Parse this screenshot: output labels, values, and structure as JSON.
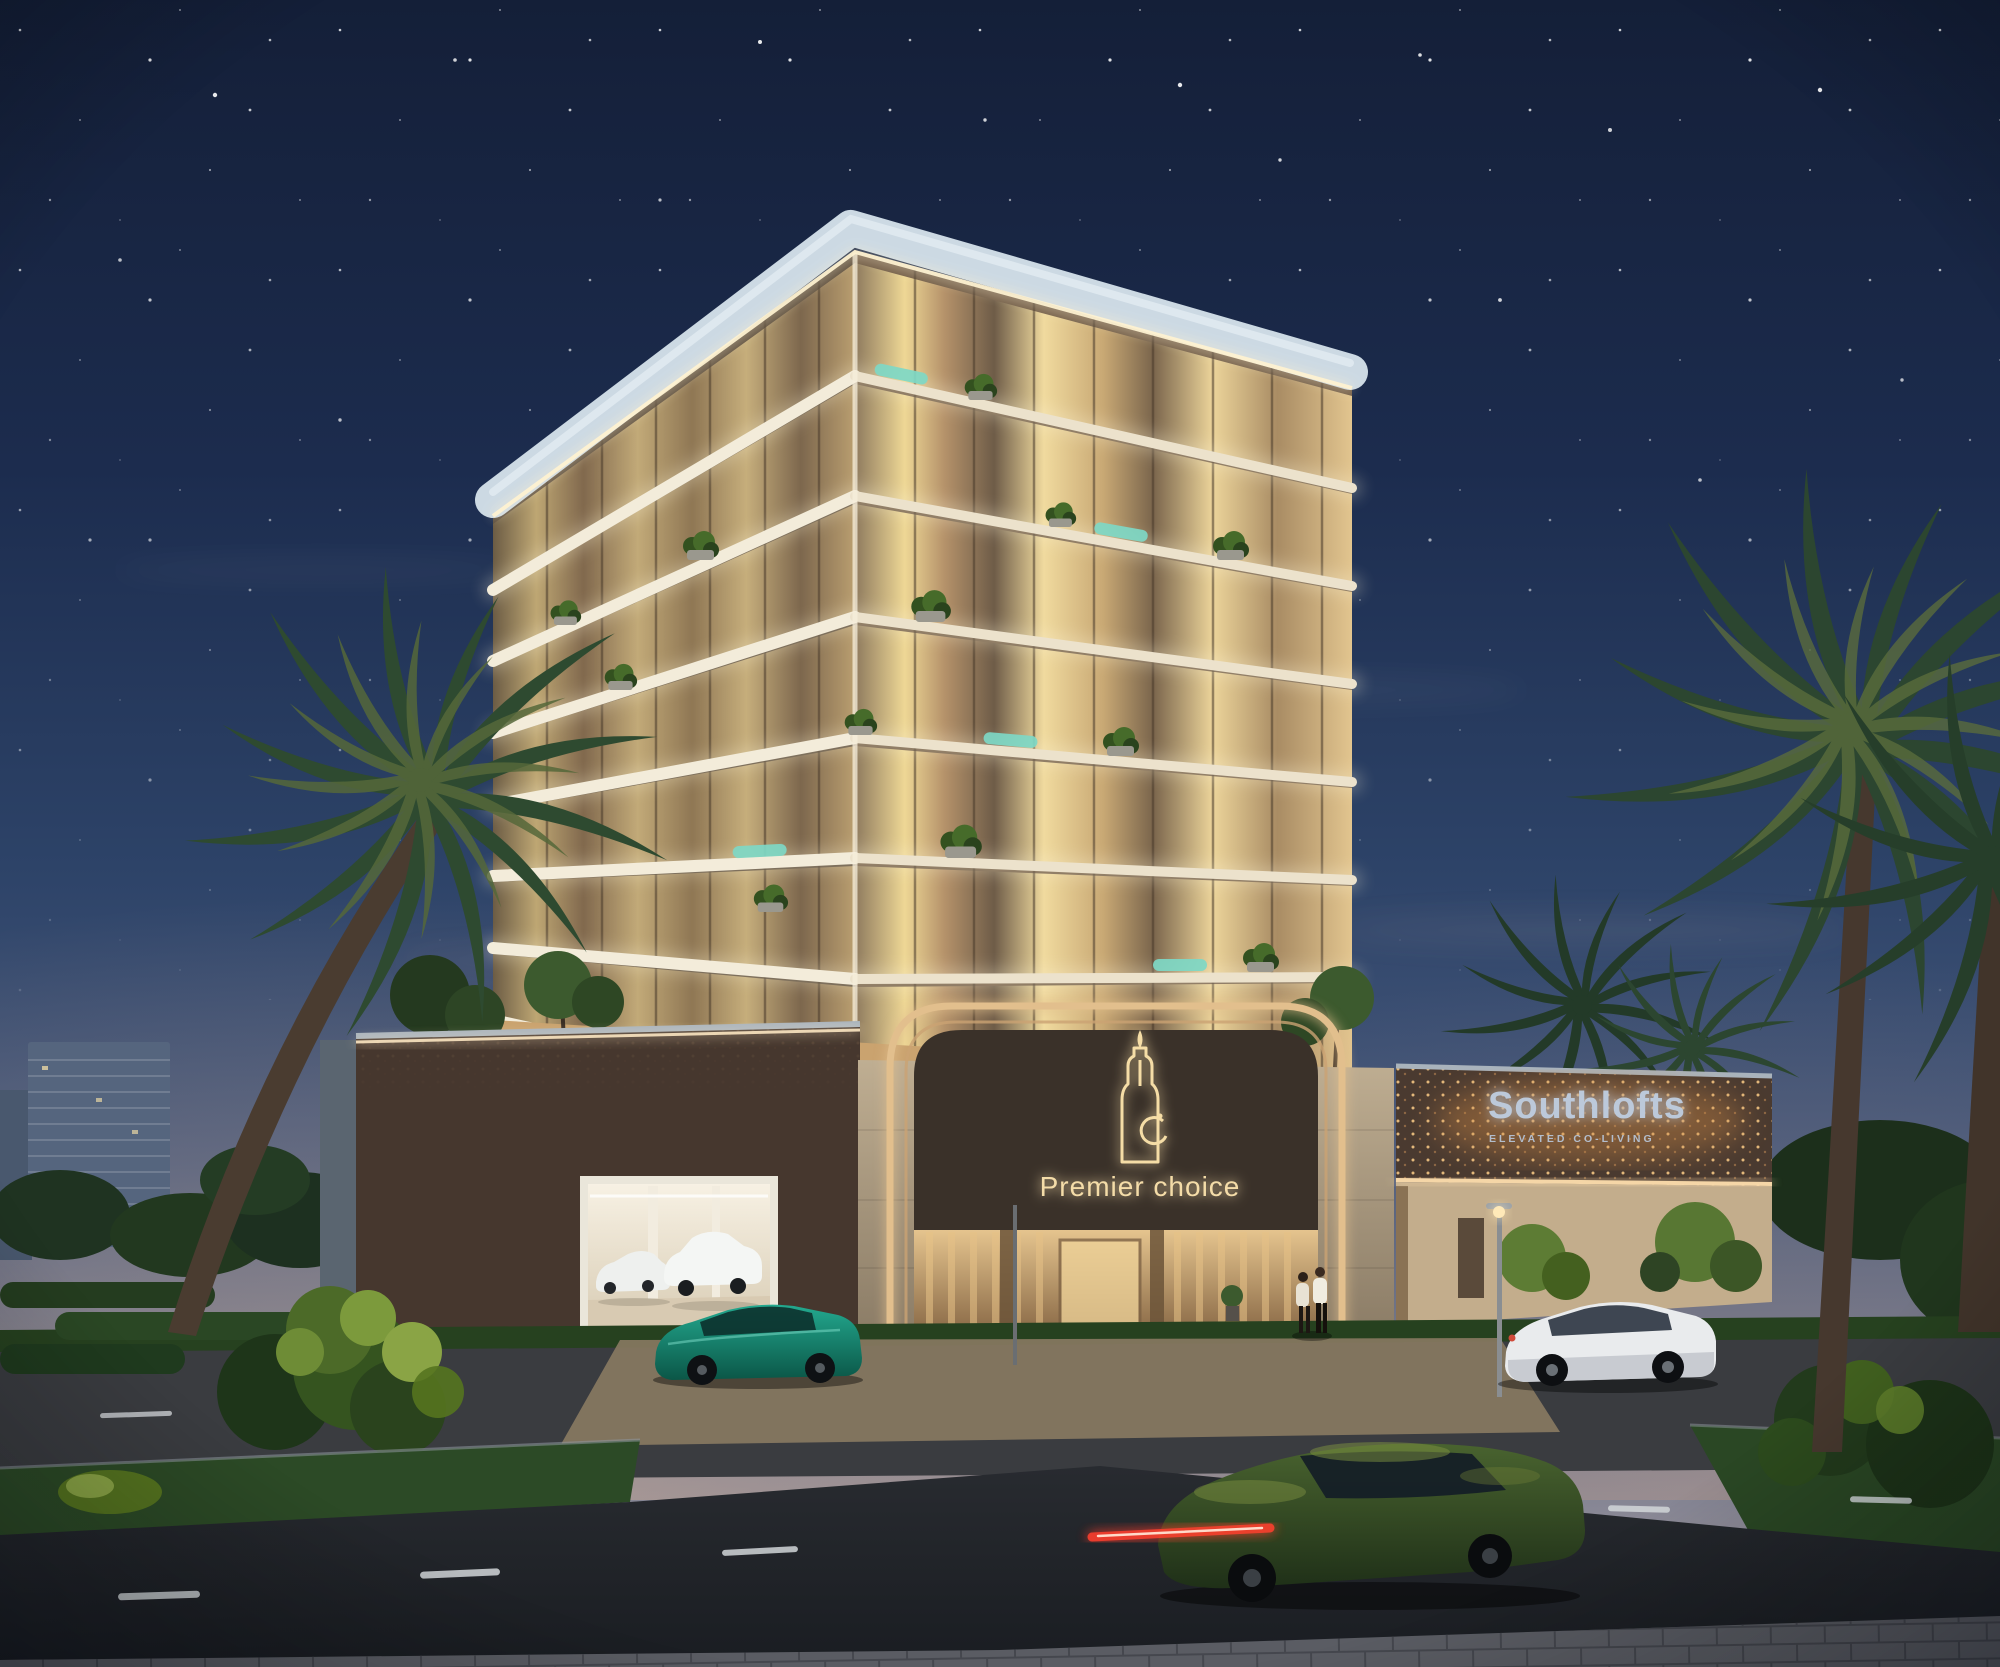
{
  "scene": {
    "caption": "Night architectural rendering of an illuminated seven-storey residential building with branded entry portal, garage, palm trees and street traffic"
  },
  "branding": {
    "premier_choice": {
      "label": "Premier choice",
      "logo": "tower-monogram-icon"
    },
    "southlofts": {
      "name": "Southlofts",
      "tagline": "ELEVATED CO-LIVING"
    }
  },
  "building": {
    "visible_floors": 7
  },
  "palette": {
    "sky_top": "#141f38",
    "sky_mid": "#2d4368",
    "sky_horizon": "#b39d96",
    "slab_glow": "#f3ecda",
    "window_warm": "#e8cf97",
    "teal_accent": "#7ed8c6",
    "roof_parapet": "#ccd9e3",
    "bronze_panel": "#46372e",
    "panel_dots": "#f3c684",
    "gold_trim": "#e2bf8d",
    "logo_glow": "#f5dda6",
    "sign_text": "#bcc9da",
    "grass": "#2c4a26",
    "road": "#23262b",
    "teal_car": "#188a76",
    "green_car": "#3c5830"
  }
}
